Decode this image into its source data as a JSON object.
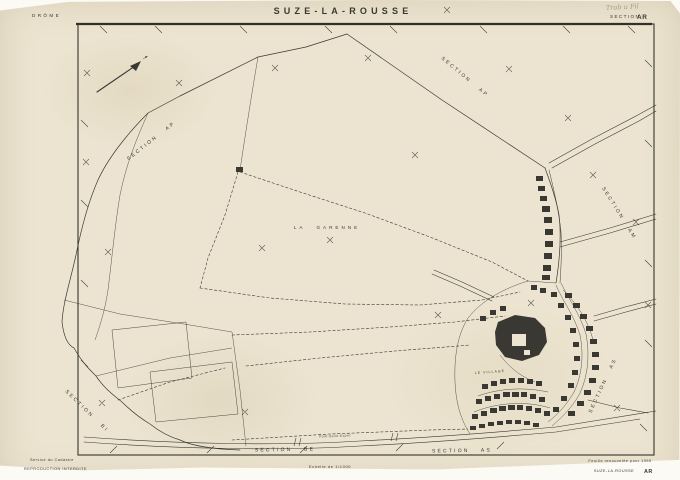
{
  "colors": {
    "paper": "#ece4d0",
    "ink": "#3a3833",
    "pencil": "#a59c87"
  },
  "header": {
    "department": "DRÔME",
    "commune": "SUZE-LA-ROUSSE",
    "section_label": "SECTION",
    "section_code": "AR",
    "handwritten_note": "Trab u Fil"
  },
  "footer": {
    "service": "Service du Cadastre",
    "reproduction": "REPRODUCTION INTERDITE",
    "scale": "Echelle de 1/1000",
    "renewal_note": "Feuille renouvelée pour 1955",
    "sheet_name": "SUZE-LA-ROUSSE",
    "sheet_code": "AR"
  },
  "map_labels": {
    "section_ap_west": "SECTION AP",
    "section_ap_north": "SECTION AP",
    "section_am": "SECTION AM",
    "section_as_east": "SECTION AS",
    "section_bi": "SECTION BI",
    "section_be": "SECTION BE",
    "section_as_south": "SECTION AS",
    "la_garenne": "LA GARENNE",
    "le_village": "LE VILLAGE",
    "road_south": "Pont-Saint-Esprit"
  }
}
